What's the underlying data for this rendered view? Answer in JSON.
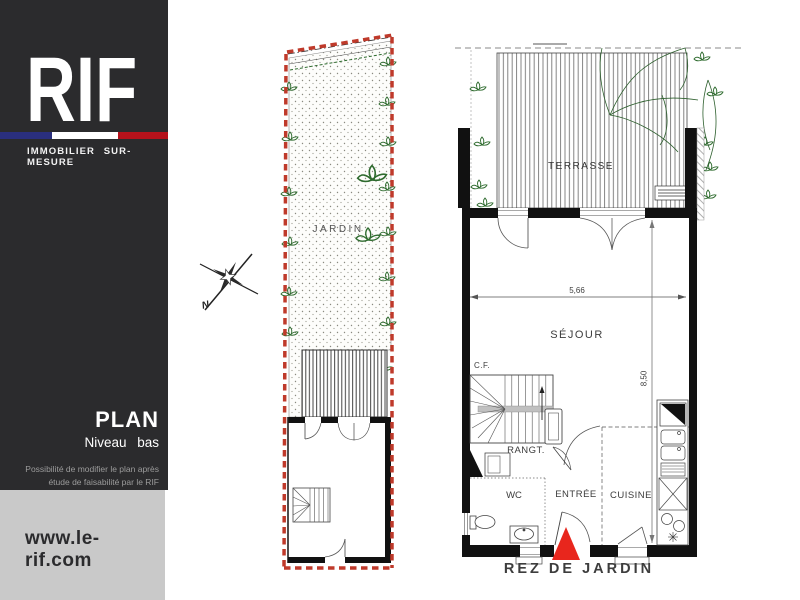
{
  "brand": {
    "logo": "RIF",
    "tagline": "IMMOBILIER SUR-MESURE",
    "website": "www.le-rif.com",
    "flag_blue": "#2a2f7e",
    "flag_white": "#ffffff",
    "flag_red": "#b5121b",
    "sidebar_bg": "#2b2b2d",
    "footer_bg": "#c9c9c9"
  },
  "sidebar": {
    "plan_title": "PLAN",
    "plan_subtitle": "Niveau bas",
    "note_line1": "Possibilité de modifier le plan après",
    "note_line2": "étude de faisabilité par le RIF"
  },
  "compass": {
    "north_label": "N"
  },
  "site_plan": {
    "garden_label": "JARDIN",
    "boundary_color": "#bf3a2b",
    "plant_color": "#2e6b2e"
  },
  "floor_plan": {
    "rooms": {
      "terrasse": "TERRASSE",
      "sejour": "SÉJOUR",
      "rangt": "RANGT.",
      "wc": "WC",
      "entree": "ENTRÉE",
      "cuisine": "CUISINE"
    },
    "annotations": {
      "cf": "C.F."
    },
    "dimensions": {
      "width": "5,66",
      "height": "8,50"
    },
    "level_label": "REZ DE JARDIN",
    "entrance_marker_color": "#e8261d"
  }
}
